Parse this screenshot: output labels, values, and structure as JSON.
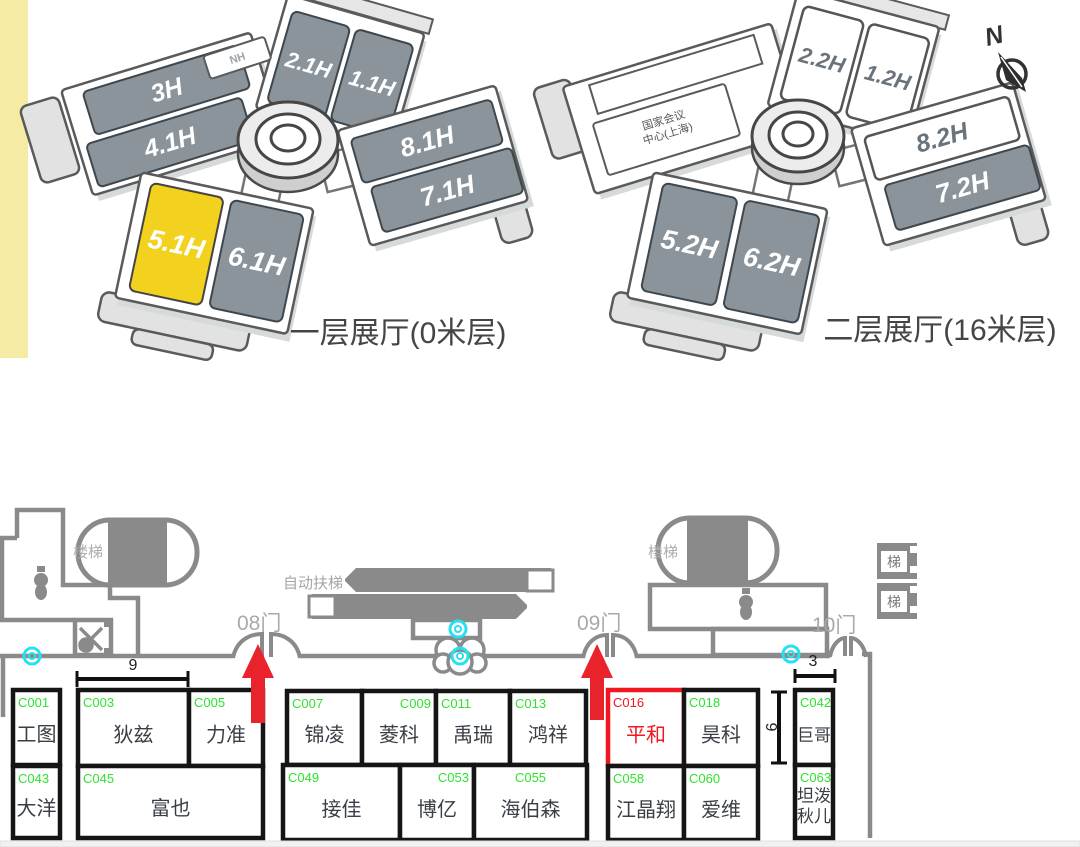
{
  "colors": {
    "yellow_strip": "#F6EBA4",
    "hall_gray": "#8B949B",
    "hall_yellow": "#F2D21F",
    "wall_gray": "#8A8A8A",
    "booth_green": "#2EE22E",
    "booth_red": "#F01720",
    "arrow_red": "#E8232B",
    "cyan_icon": "#29E0F2"
  },
  "floor1": {
    "caption": "一层展厅(0米层)",
    "halls": {
      "nh": "NH",
      "h3": "3H",
      "h41": "4.1H",
      "h21": "2.1H",
      "h11": "1.1H",
      "h81": "8.1H",
      "h71": "7.1H",
      "h51": "5.1H",
      "h61": "6.1H"
    }
  },
  "floor2": {
    "caption": "二层展厅(16米层)",
    "conf_line1": "国家会议",
    "conf_line2": "中心(上海)",
    "halls": {
      "h22": "2.2H",
      "h12": "1.2H",
      "h82": "8.2H",
      "h72": "7.2H",
      "h52": "5.2H",
      "h62": "6.2H"
    }
  },
  "compass": {
    "north": "N"
  },
  "floorplan": {
    "stairs": "楼梯",
    "escalator": "自动扶梯",
    "elevator": "梯",
    "doors": {
      "d08": "08门",
      "d09": "09门",
      "d10": "10门"
    },
    "dims": {
      "w9": "9",
      "w3": "3",
      "h6": "6"
    },
    "booths": [
      {
        "code": "C001",
        "name": "工图",
        "x": 13,
        "y": 690,
        "w": 47,
        "h": 75
      },
      {
        "code": "C043",
        "name": "大洋",
        "x": 13,
        "y": 766,
        "w": 47,
        "h": 72
      },
      {
        "code": "C003",
        "name": "狄兹",
        "x": 78,
        "y": 690,
        "w": 111,
        "h": 76
      },
      {
        "code": "C005",
        "name": "力准",
        "x": 189,
        "y": 690,
        "w": 74,
        "h": 76
      },
      {
        "code": "C045",
        "name": "富也",
        "x": 78,
        "y": 766,
        "w": 185,
        "h": 72
      },
      {
        "code": "C007",
        "name": "锦凌",
        "x": 287,
        "y": 691,
        "w": 75,
        "h": 74
      },
      {
        "code": "C009",
        "name": "菱科",
        "x": 362,
        "y": 691,
        "w": 74,
        "h": 74,
        "codePos": "tr"
      },
      {
        "code": "C011",
        "name": "禹瑞",
        "x": 436,
        "y": 691,
        "w": 74,
        "h": 74
      },
      {
        "code": "C013",
        "name": "鸿祥",
        "x": 510,
        "y": 691,
        "w": 76,
        "h": 74
      },
      {
        "code": "C049",
        "name": "接佳",
        "x": 283,
        "y": 765,
        "w": 117,
        "h": 75
      },
      {
        "code": "C053",
        "name": "博亿",
        "x": 400,
        "y": 765,
        "w": 74,
        "h": 75,
        "codePos": "tr"
      },
      {
        "code": "C055",
        "name": "海伯森",
        "x": 474,
        "y": 765,
        "w": 113,
        "h": 75,
        "codePos": "tc"
      },
      {
        "code": "C016",
        "name": "平和",
        "x": 608,
        "y": 690,
        "w": 76,
        "h": 76,
        "color": "red"
      },
      {
        "code": "C018",
        "name": "昊科",
        "x": 684,
        "y": 690,
        "w": 74,
        "h": 76
      },
      {
        "code": "C058",
        "name": "江晶翔",
        "x": 608,
        "y": 766,
        "w": 76,
        "h": 74
      },
      {
        "code": "C060",
        "name": "爱维",
        "x": 684,
        "y": 766,
        "w": 74,
        "h": 74
      },
      {
        "code": "C042",
        "name": "巨哥",
        "x": 795,
        "y": 690,
        "w": 38,
        "h": 75
      },
      {
        "code": "C063",
        "name": "坦泼秋儿",
        "x": 795,
        "y": 765,
        "w": 38,
        "h": 73,
        "lines": [
          "坦泼",
          "秋儿"
        ]
      }
    ]
  }
}
